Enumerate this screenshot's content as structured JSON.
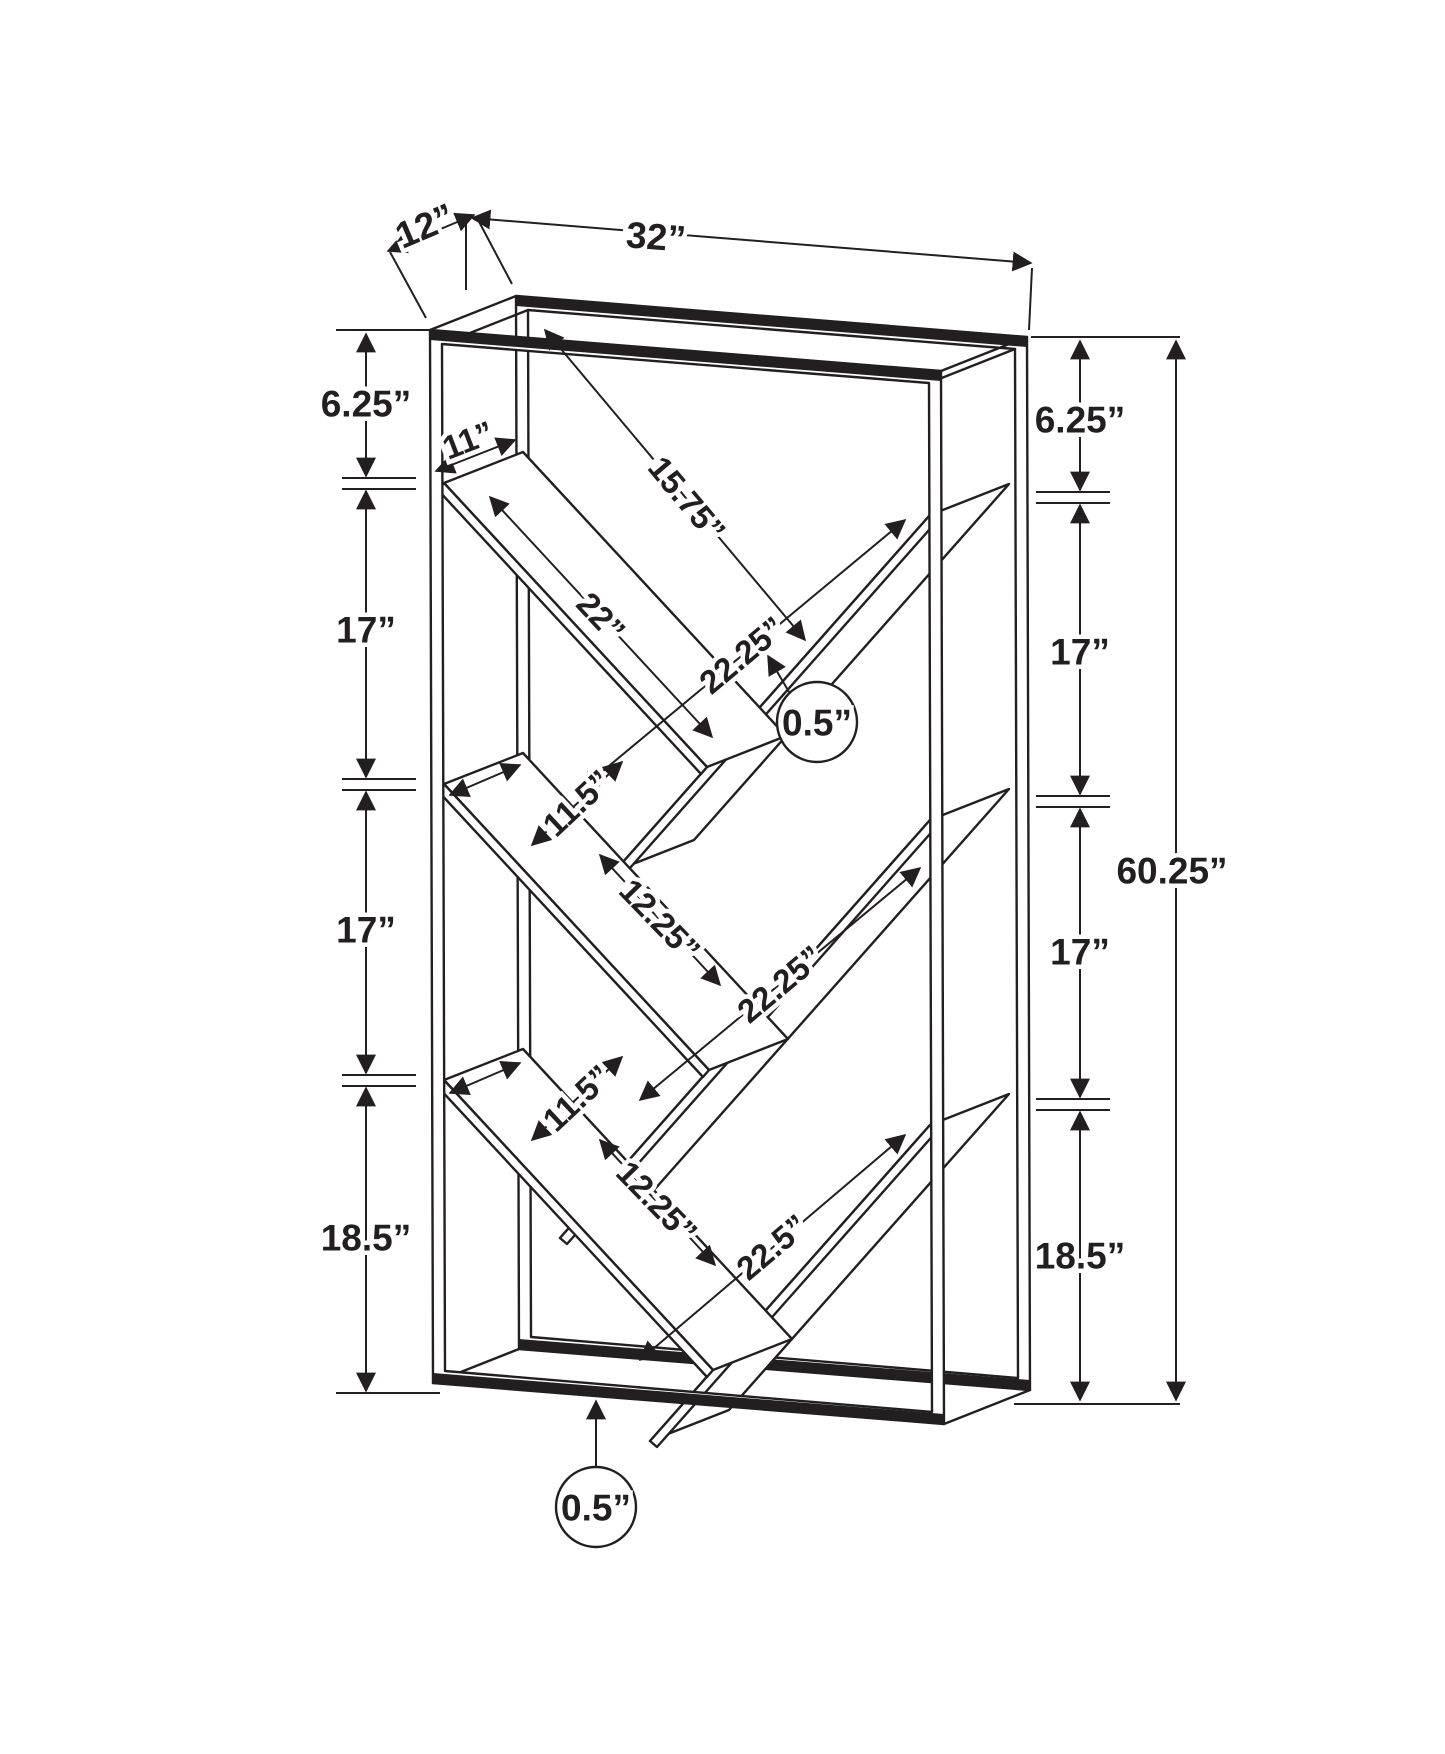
{
  "colors": {
    "line": "#231f20",
    "background": "#ffffff"
  },
  "drawing": {
    "kind": "furniture dimension diagram",
    "overall": {
      "depth": "12”",
      "width": "32”",
      "height": "60.25”"
    },
    "left_chain": [
      "6.25”",
      "17”",
      "17”",
      "18.5”"
    ],
    "right_chain": [
      "6.25”",
      "17”",
      "17”",
      "18.5”"
    ],
    "top_bay": {
      "shelf_width": "11”",
      "clearance": "15.75”",
      "left_shelf_length": "22”",
      "right_shelf_length": "22.25”",
      "shelf_thickness": "0.5”"
    },
    "mid_bay": {
      "shelf_width": "9.25”",
      "gap": "11.5”",
      "spacing": "12.25”",
      "right_shelf_length": "22.25”"
    },
    "bottom_bay": {
      "shelf_width": "9.25”",
      "gap": "11.5”",
      "spacing": "12.25”",
      "right_shelf_length": "22.5”"
    },
    "base_thickness": "0.5”"
  }
}
